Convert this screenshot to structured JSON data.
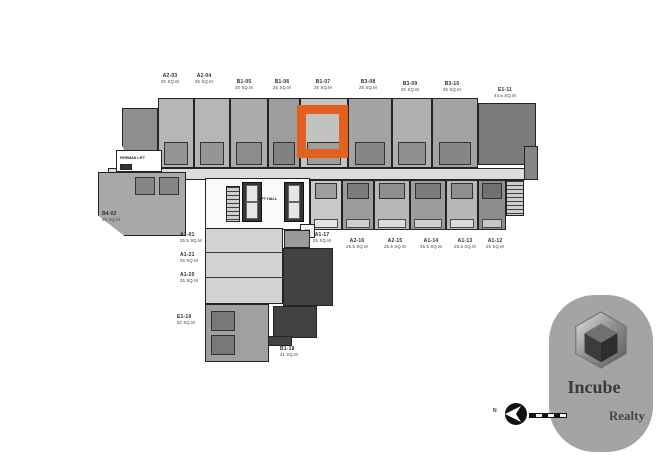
{
  "plan": {
    "highlight_color": "#e2611c",
    "selected_unit": "B1-07",
    "unit_labels": [
      {
        "name": "unit-label-a2-03",
        "id": "A2-03",
        "area": "25 SQ.M",
        "x": 170,
        "y": 73,
        "anchor": "c"
      },
      {
        "name": "unit-label-a2-04",
        "id": "A2-04",
        "area": "25 SQ.M",
        "x": 204,
        "y": 73,
        "anchor": "c"
      },
      {
        "name": "unit-label-b1-05",
        "id": "B1-05",
        "area": "25 SQ.M",
        "x": 244,
        "y": 79,
        "anchor": "c"
      },
      {
        "name": "unit-label-b1-06",
        "id": "B1-06",
        "area": "25 SQ.M",
        "x": 282,
        "y": 79,
        "anchor": "c"
      },
      {
        "name": "unit-label-b1-07",
        "id": "B1-07",
        "area": "25 SQ.M",
        "x": 323,
        "y": 79,
        "anchor": "c",
        "highlighted": true
      },
      {
        "name": "unit-label-b3-08",
        "id": "B3-08",
        "area": "25 SQ.M",
        "x": 368,
        "y": 79,
        "anchor": "c"
      },
      {
        "name": "unit-label-b3-09",
        "id": "B3-09",
        "area": "25 SQ.M",
        "x": 410,
        "y": 81,
        "anchor": "c"
      },
      {
        "name": "unit-label-b3-10",
        "id": "B3-10",
        "area": "25 SQ.M",
        "x": 452,
        "y": 81,
        "anchor": "c"
      },
      {
        "name": "unit-label-e1-11",
        "id": "E1-11",
        "area": "44.5 SQ.M",
        "x": 505,
        "y": 87,
        "anchor": "c"
      },
      {
        "name": "unit-label-b4-02",
        "id": "B4-02",
        "area": "25 SQ.M",
        "x": 102,
        "y": 211,
        "anchor": "l"
      },
      {
        "name": "unit-label-a1-01",
        "id": "A1-01",
        "area": "25.5 SQ.M",
        "x": 180,
        "y": 232,
        "anchor": "l"
      },
      {
        "name": "unit-label-a1-21",
        "id": "A1-21",
        "area": "25 SQ.M",
        "x": 180,
        "y": 252,
        "anchor": "l"
      },
      {
        "name": "unit-label-a1-20",
        "id": "A1-20",
        "area": "25 SQ.M",
        "x": 180,
        "y": 272,
        "anchor": "l"
      },
      {
        "name": "unit-label-e1-19",
        "id": "E1-19",
        "area": "52 SQ.M",
        "x": 177,
        "y": 314,
        "anchor": "l"
      },
      {
        "name": "unit-label-b1-18",
        "id": "B1-18",
        "area": "41 SQ.M",
        "x": 280,
        "y": 346,
        "anchor": "l"
      },
      {
        "name": "unit-label-a1-17",
        "id": "A1-17",
        "area": "25 SQ.M",
        "x": 322,
        "y": 232,
        "anchor": "c"
      },
      {
        "name": "unit-label-a2-16",
        "id": "A2-16",
        "area": "25.5 SQ.M",
        "x": 357,
        "y": 238,
        "anchor": "c"
      },
      {
        "name": "unit-label-a2-15",
        "id": "A2-15",
        "area": "25.5 SQ.M",
        "x": 395,
        "y": 238,
        "anchor": "c"
      },
      {
        "name": "unit-label-a1-14",
        "id": "A1-14",
        "area": "25.5 SQ.M",
        "x": 431,
        "y": 238,
        "anchor": "c"
      },
      {
        "name": "unit-label-a1-13",
        "id": "A1-13",
        "area": "25.5 SQ.M",
        "x": 465,
        "y": 238,
        "anchor": "c"
      },
      {
        "name": "unit-label-a1-12",
        "id": "A1-12",
        "area": "25 SQ.M",
        "x": 495,
        "y": 238,
        "anchor": "c"
      }
    ],
    "core": {
      "fireman_lift": "FIREMAN LIFT",
      "lift_hall": "LIFT HALL",
      "garbage": "GB"
    },
    "compass": {
      "north": "N"
    }
  },
  "watermark": {
    "brand": "Incube",
    "brand2": "Realty"
  }
}
